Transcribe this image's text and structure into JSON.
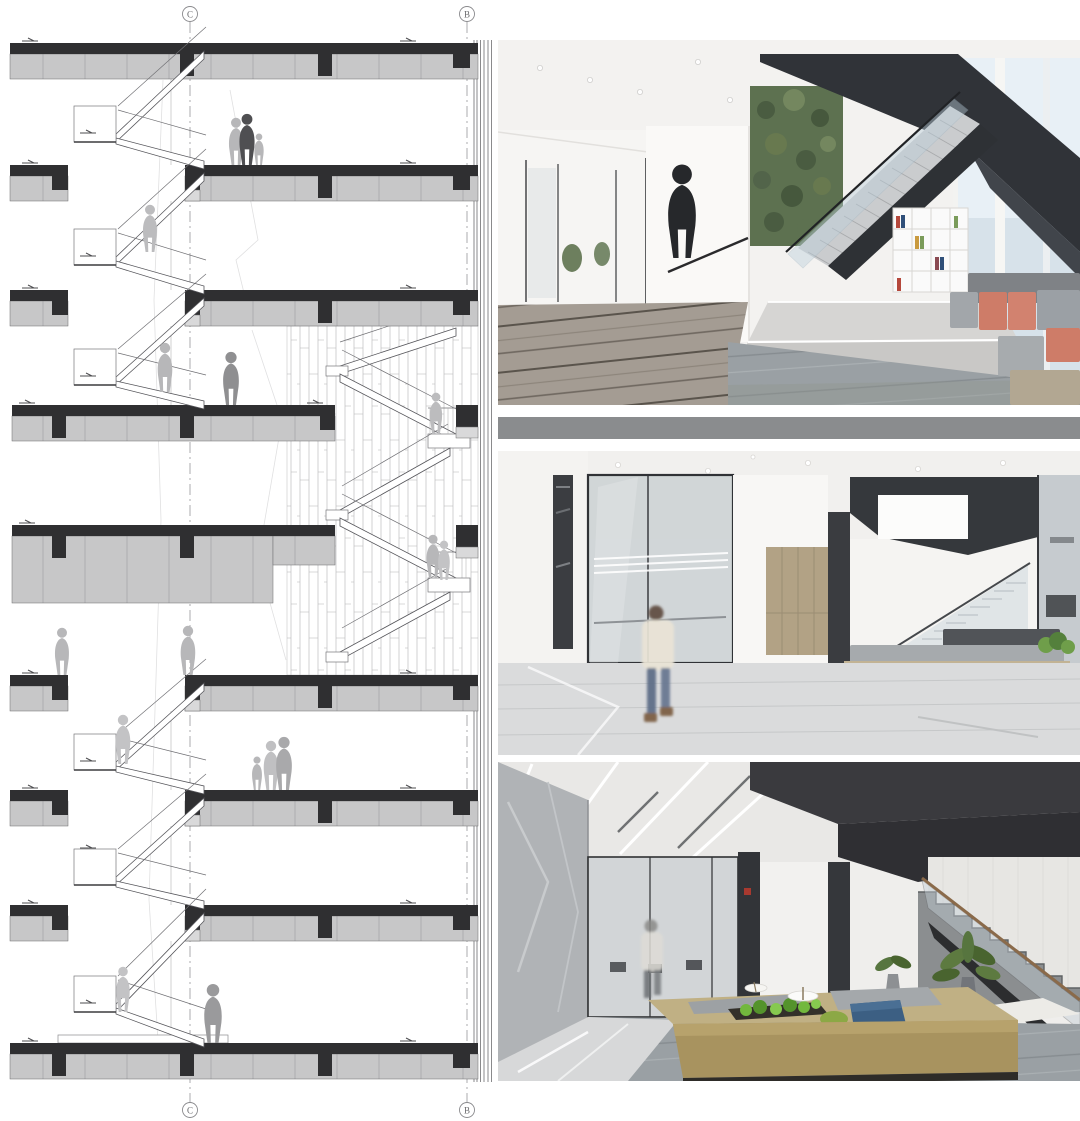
{
  "page": {
    "title": "Stair section drawing with three interior photographs",
    "background": "#ffffff"
  },
  "section": {
    "alt": "Architectural section through a multi-storey connecting stair with floor slabs, zig-zag flights, curtain-wall hatch zone and human silhouettes",
    "grid_bubbles": [
      {
        "id": "top-c",
        "label": "C"
      },
      {
        "id": "top-b",
        "label": "B"
      },
      {
        "id": "bottom-c",
        "label": "C"
      },
      {
        "id": "bottom-b",
        "label": "B"
      }
    ],
    "colors": {
      "slab_dark": "#2f2f31",
      "slab_fill": "#c7c7c8",
      "outline": "#55555a",
      "figure_light": "#b7b7b9",
      "figure_mid": "#8f8f91",
      "figure_dark": "#4f4f52",
      "hatch_line": "#b3b3b5",
      "grid_line": "#97979b"
    }
  },
  "photos": [
    {
      "id": "photo-1",
      "alt": "Office lounge with black angular feature staircase, plant wall, white cube bookshelf, grey and coral modular sofas on striped carpet",
      "palette": {
        "stair": "#303338",
        "plant_wall": "#5d7150",
        "coral": "#ce7c68",
        "sofa_grey": "#a2a6aa",
        "carpet": "#a29a90",
        "window": "#d7e2ea"
      }
    },
    {
      "id": "photo-2",
      "alt": "Lobby with marble floor, glass partitions, blurred walking figure, long bench with tan base and grey cushion beside a glass-balustrade stair",
      "palette": {
        "soffit": "#35383c",
        "bench_base": "#c2b394",
        "cushion": "#a6aaad",
        "marble": "#dadbdc",
        "glass": "#ccd1d4"
      }
    },
    {
      "id": "photo-3",
      "alt": "Lounge with long brass planter bench, green plants, blue ottoman, white side tables and dark steel stair with glass balustrade",
      "palette": {
        "brass": "#a8935f",
        "plants": "#6fae3f",
        "blue": "#3c5f83",
        "carpet": "#9aa0a4",
        "stair": "#3a3a3e"
      }
    }
  ]
}
